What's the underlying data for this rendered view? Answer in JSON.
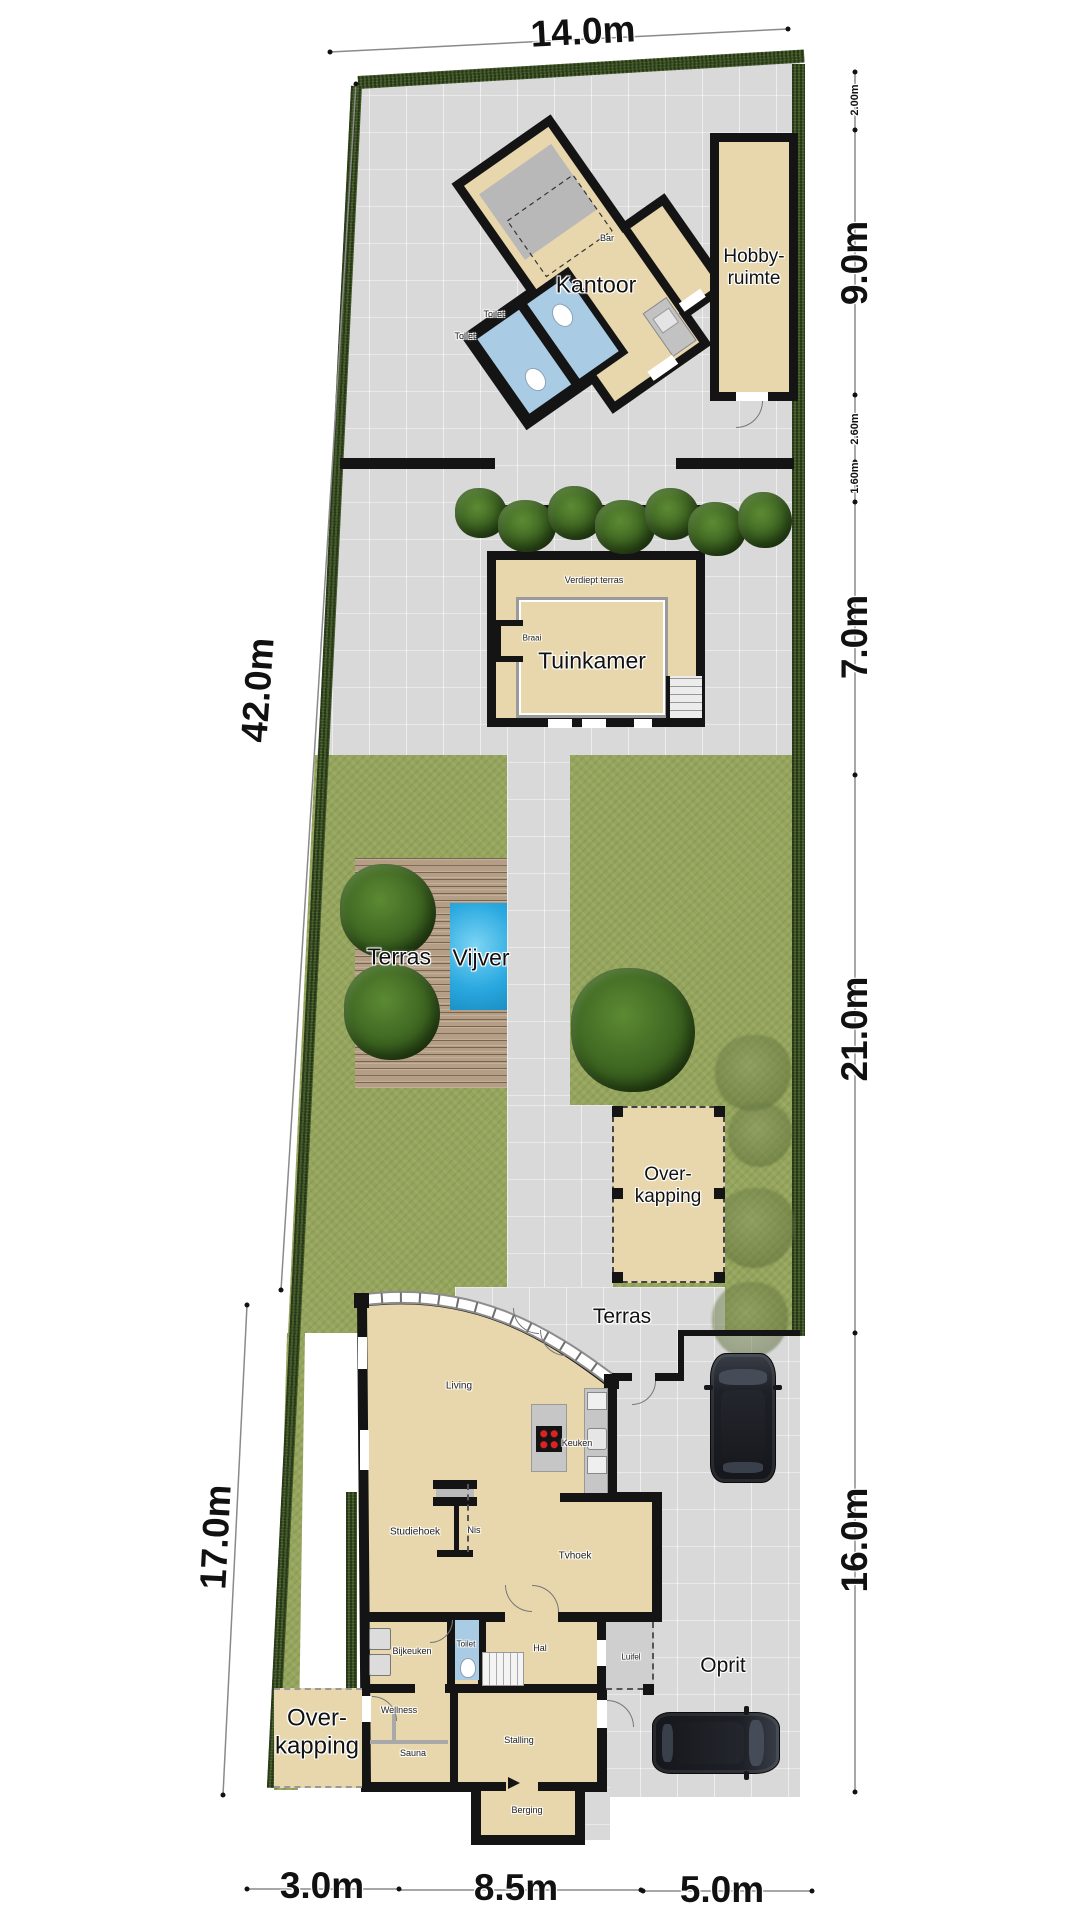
{
  "plan": {
    "dims": {
      "top": "14.0m",
      "left_total": "42.0m",
      "left_lower": "17.0m",
      "right_seg_small_1": "2.00m",
      "right_seg_1": "9.0m",
      "right_seg_small_2": "2.60m",
      "right_seg_small_3": "1.60m",
      "right_seg_2": "7.0m",
      "right_seg_3": "21.0m",
      "right_seg_4": "16.0m",
      "bottom_seg_1": "3.0m",
      "bottom_seg_2": "8.5m",
      "bottom_seg_3": "5.0m"
    },
    "labels": {
      "kantoor": "Kantoor",
      "bar": "Bar",
      "toilet_kantoor_1": "Toilet",
      "toilet_kantoor_2": "Toilet",
      "hobbyruimte": "Hobby-ruimte",
      "verdiept_terras": "Verdiept terras",
      "braai": "Braai",
      "tuinkamer": "Tuinkamer",
      "terras_garden": "Terras",
      "vijver": "Vijver",
      "overkapping_garden": "Over-kapping",
      "terras_house": "Terras",
      "living": "Living",
      "keuken": "Keuken",
      "studiehoek": "Studiehoek",
      "nis": "Nis",
      "tvhoek": "Tvhoek",
      "bijkeuken": "Bijkeuken",
      "toilet_house": "Toilet",
      "hal": "Hal",
      "luifel": "Luifel",
      "wellness": "Wellness",
      "sauna": "Sauna",
      "stalling": "Stalling",
      "berging": "Berging",
      "oprit": "Oprit",
      "overkapping_house": "Over-kapping"
    },
    "colors": {
      "paving": "#d9d9d9",
      "grass": "#95a55b",
      "hedge": "#3c5522",
      "room_fill": "#e8d7ac",
      "wall": "#141414",
      "water": "#2aa9e0",
      "toilet_room": "#aacbe4",
      "deck": "#b49f86",
      "counter": "#c6c6c6",
      "luifel": "#cfcfcf"
    }
  }
}
